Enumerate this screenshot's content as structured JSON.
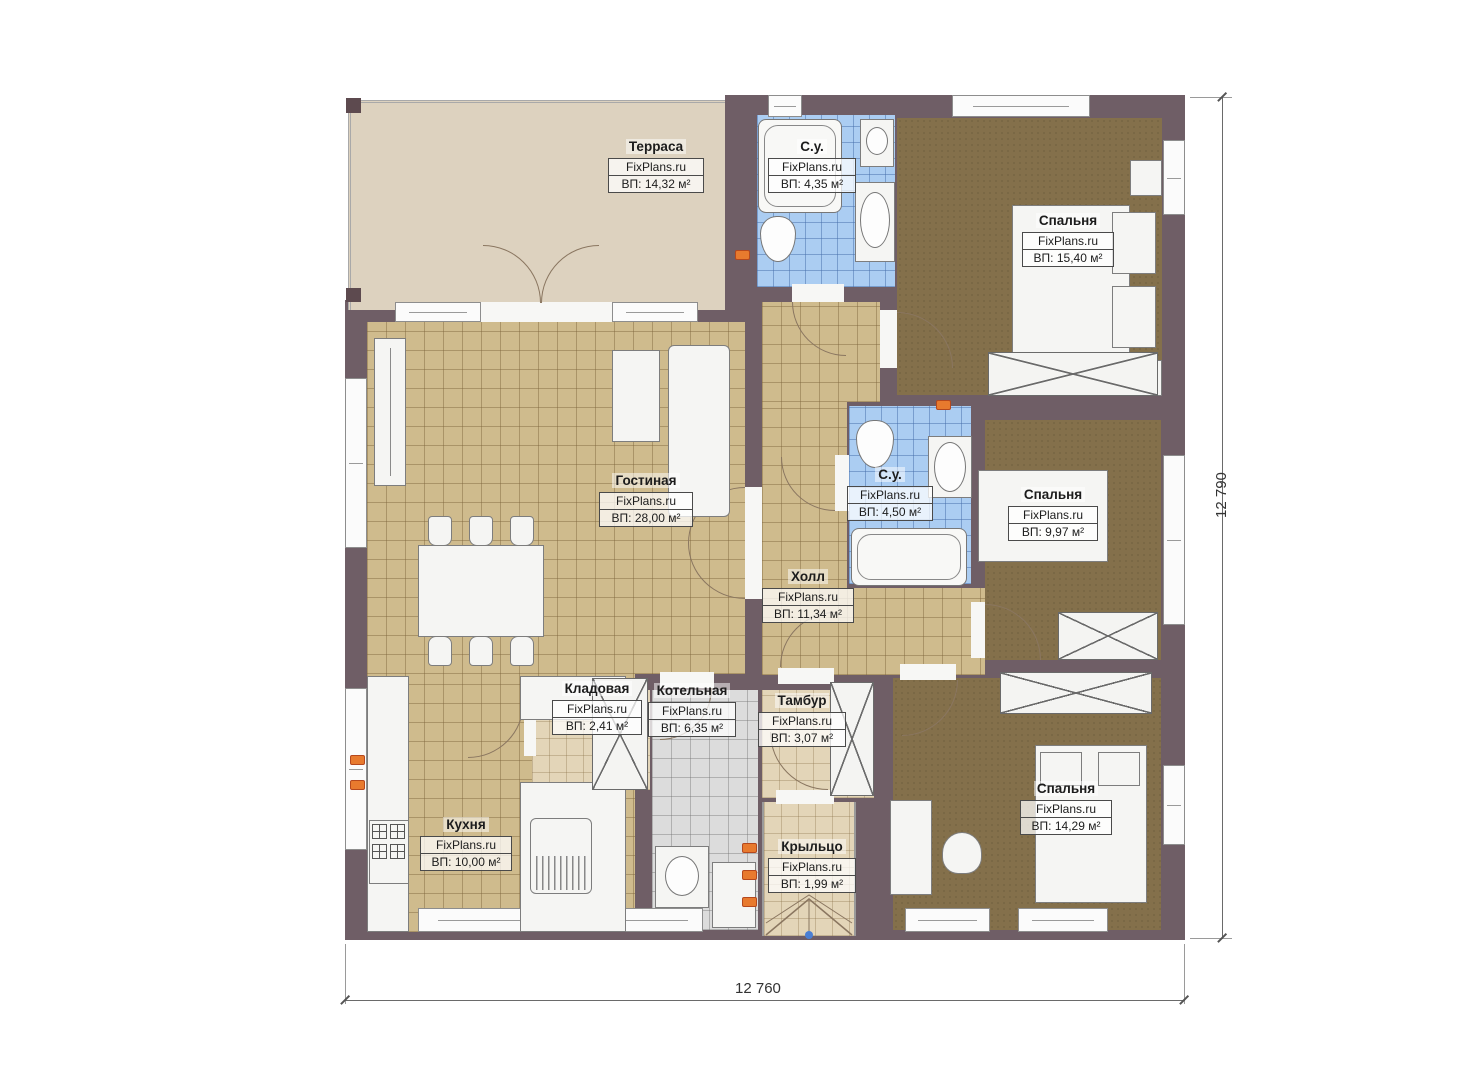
{
  "watermark": "FixPlans.ru",
  "rooms": [
    {
      "id": "terrace",
      "name": "Терраса",
      "area": "ВП: 14,32 м²"
    },
    {
      "id": "bathroom-top",
      "name": "С.у.",
      "area": "ВП: 4,35 м²"
    },
    {
      "id": "bedroom-top-right",
      "name": "Спальня",
      "area": "ВП: 15,40 м²"
    },
    {
      "id": "living-room",
      "name": "Гостиная",
      "area": "ВП: 28,00 м²"
    },
    {
      "id": "bathroom-mid",
      "name": "С.у.",
      "area": "ВП: 4,50 м²"
    },
    {
      "id": "bedroom-mid-right",
      "name": "Спальня",
      "area": "ВП: 9,97 м²"
    },
    {
      "id": "hall",
      "name": "Холл",
      "area": "ВП: 11,34 м²"
    },
    {
      "id": "storage",
      "name": "Кладовая",
      "area": "ВП: 2,41 м²"
    },
    {
      "id": "boiler-room",
      "name": "Котельная",
      "area": "ВП: 6,35 м²"
    },
    {
      "id": "vestibule",
      "name": "Тамбур",
      "area": "ВП: 3,07 м²"
    },
    {
      "id": "kitchen",
      "name": "Кухня",
      "area": "ВП: 10,00 м²"
    },
    {
      "id": "porch",
      "name": "Крыльцо",
      "area": "ВП: 1,99 м²"
    },
    {
      "id": "bedroom-bottom-right",
      "name": "Спальня",
      "area": "ВП: 14,29 м²"
    }
  ],
  "dimensions": {
    "width_label": "12 760",
    "height_label": "12 790"
  },
  "colors": {
    "wall": "#6f5e66",
    "floor_tile": "#cfbb8d",
    "floor_bath": "#abcdf2",
    "floor_carpet": "#84704b",
    "floor_boiler": "#dcdcdc",
    "terrace": "#ddd2bf",
    "socket": "#e87a2e",
    "entry_marker": "#4a7fd4"
  }
}
